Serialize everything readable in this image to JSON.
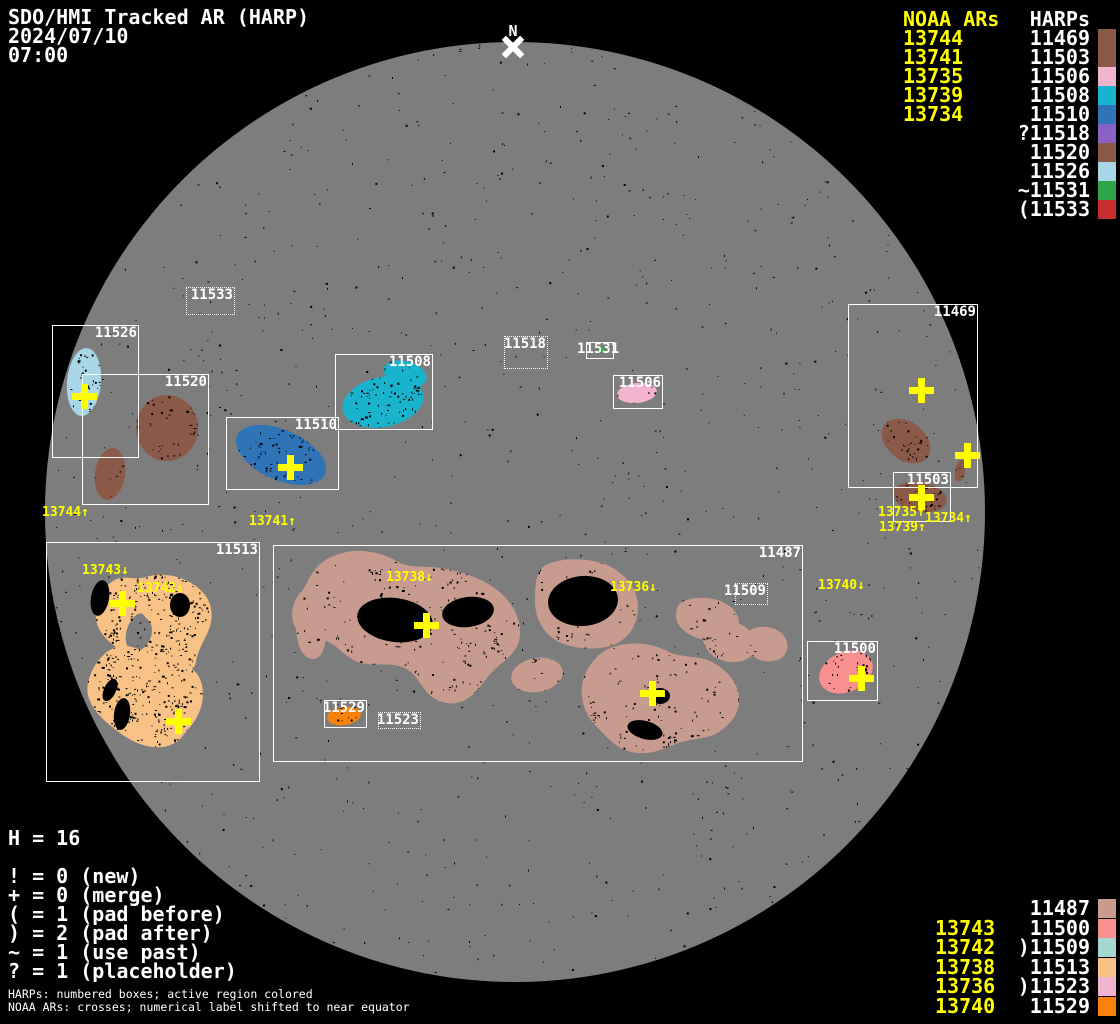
{
  "header": {
    "title": "SDO/HMI Tracked AR (HARP)",
    "date": "2024/07/10",
    "time": "07:00"
  },
  "north_marker": {
    "label": "N"
  },
  "colors": {
    "background": "#000000",
    "disk": "#7d7d7d",
    "noaa_yellow": "#ffff00",
    "harp_white": "#ffffff",
    "regions": {
      "11469": "#8b5948",
      "11487": "#c79c8e",
      "11500": "#f89090",
      "11503": "#8b5948",
      "11506": "#f2b3cd",
      "11508": "#1ab3cd",
      "11509": "#a6d8d0",
      "11510": "#2e74b6",
      "11513": "#f8c286",
      "11518": "#8a62c6",
      "11520": "#8b5948",
      "11523": "#f2b3cd",
      "11526": "#a8d6e6",
      "11529": "#f8820a",
      "11531": "#2fa44a",
      "11533": "#c92e2e"
    }
  },
  "legend_top_right": {
    "noaa_header": "NOAA ARs",
    "harp_header": "HARPs",
    "rows": [
      {
        "noaa": "13744",
        "harp": "11469"
      },
      {
        "noaa": "13741",
        "harp": "11503"
      },
      {
        "noaa": "13735",
        "harp": "11506"
      },
      {
        "noaa": "13739",
        "harp": "11508"
      },
      {
        "noaa": "13734",
        "harp": "11510"
      },
      {
        "noaa": "",
        "harp": "?11518"
      },
      {
        "noaa": "",
        "harp": "11520"
      },
      {
        "noaa": "",
        "harp": "11526"
      },
      {
        "noaa": "",
        "harp": "~11531"
      },
      {
        "noaa": "",
        "harp": "(11533"
      }
    ]
  },
  "legend_bottom_right": {
    "rows": [
      {
        "noaa": "",
        "harp": "11487"
      },
      {
        "noaa": "13743",
        "harp": "11500"
      },
      {
        "noaa": "13742",
        "harp": ")11509"
      },
      {
        "noaa": "13738",
        "harp": "11513"
      },
      {
        "noaa": "13736",
        "harp": ")11523"
      },
      {
        "noaa": "13740",
        "harp": "11529"
      }
    ]
  },
  "stats": {
    "harp_count": "H = 16"
  },
  "flag_legend": [
    "! = 0 (new)",
    "+ = 0 (merge)",
    "( = 1 (pad before)",
    ") = 2 (pad after)",
    "~ = 1 (use past)",
    "? = 1 (placeholder)"
  ],
  "footnotes": [
    "HARPs: numbered boxes; active region colored",
    "NOAA ARs: crosses; numerical label shifted to near equator"
  ],
  "disk": {
    "cx": 515,
    "cy": 512,
    "r": 470
  },
  "harp_boxes": [
    {
      "harp": "11469",
      "x": 848,
      "y": 304,
      "w": 130,
      "h": 184,
      "style": "solid"
    },
    {
      "harp": "11487",
      "x": 273,
      "y": 545,
      "w": 530,
      "h": 217,
      "style": "solid"
    },
    {
      "harp": "11500",
      "x": 807,
      "y": 641,
      "w": 71,
      "h": 60,
      "style": "solid"
    },
    {
      "harp": "11503",
      "x": 893,
      "y": 472,
      "w": 58,
      "h": 50,
      "style": "solid"
    },
    {
      "harp": "11506",
      "x": 613,
      "y": 375,
      "w": 50,
      "h": 34,
      "style": "solid"
    },
    {
      "harp": "11508",
      "x": 335,
      "y": 354,
      "w": 98,
      "h": 76,
      "style": "solid"
    },
    {
      "harp": "11509",
      "x": 735,
      "y": 583,
      "w": 33,
      "h": 22,
      "style": "dotted"
    },
    {
      "harp": "11510",
      "x": 226,
      "y": 417,
      "w": 113,
      "h": 73,
      "style": "solid"
    },
    {
      "harp": "11513",
      "x": 46,
      "y": 542,
      "w": 214,
      "h": 240,
      "style": "solid"
    },
    {
      "harp": "11518",
      "x": 504,
      "y": 336,
      "w": 44,
      "h": 33,
      "style": "dotted"
    },
    {
      "harp": "11520",
      "x": 82,
      "y": 374,
      "w": 127,
      "h": 131,
      "style": "solid"
    },
    {
      "harp": "11523",
      "x": 378,
      "y": 712,
      "w": 43,
      "h": 17,
      "style": "dotted"
    },
    {
      "harp": "11526",
      "x": 52,
      "y": 325,
      "w": 87,
      "h": 133,
      "style": "solid"
    },
    {
      "harp": "11529",
      "x": 324,
      "y": 700,
      "w": 43,
      "h": 28,
      "style": "solid"
    },
    {
      "harp": "11531",
      "x": 586,
      "y": 342,
      "w": 28,
      "h": 17,
      "style": "solid",
      "label_outside": true
    },
    {
      "harp": "11533",
      "x": 186,
      "y": 287,
      "w": 49,
      "h": 28,
      "style": "dotted"
    }
  ],
  "noaa_crosses": [
    {
      "x": 84,
      "y": 396
    },
    {
      "x": 290,
      "y": 467
    },
    {
      "x": 921,
      "y": 390
    },
    {
      "x": 967,
      "y": 455
    },
    {
      "x": 921,
      "y": 497
    },
    {
      "x": 122,
      "y": 603
    },
    {
      "x": 178,
      "y": 721
    },
    {
      "x": 426,
      "y": 625
    },
    {
      "x": 652,
      "y": 693
    },
    {
      "x": 861,
      "y": 678
    }
  ],
  "noaa_labels": [
    {
      "text": "13744↑",
      "x": 42,
      "y": 506
    },
    {
      "text": "13741↑",
      "x": 249,
      "y": 515
    },
    {
      "text": "13743↓",
      "x": 82,
      "y": 564
    },
    {
      "text": "13742↓",
      "x": 137,
      "y": 582
    },
    {
      "text": "13738↓",
      "x": 386,
      "y": 571
    },
    {
      "text": "13736↓",
      "x": 610,
      "y": 581
    },
    {
      "text": "13740↓",
      "x": 818,
      "y": 579
    },
    {
      "text": "13735↑",
      "x": 878,
      "y": 506
    },
    {
      "text": "13739↑",
      "x": 879,
      "y": 521
    },
    {
      "text": "13734↑",
      "x": 925,
      "y": 512
    }
  ]
}
